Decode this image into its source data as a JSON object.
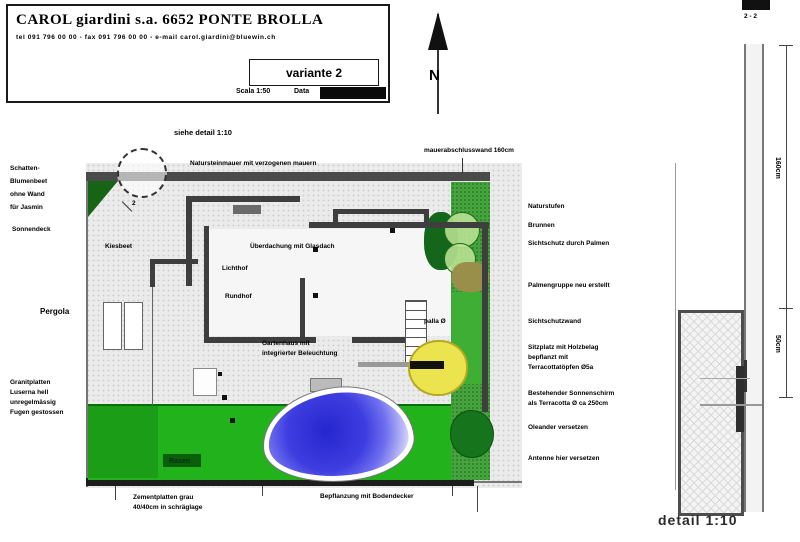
{
  "title_block": {
    "company": "CAROL giardini s.a. 6652 PONTE BROLLA",
    "contact": "tel 091 796 00 00 - fax 091 796 00 00 - e-mail carol.giardini@bluewin.ch",
    "variant": "variante 2",
    "scale_label": "Scala 1:50",
    "date_label": "Data"
  },
  "north_letter": "N",
  "plan_labels": {
    "see_detail": "siehe detail 1:10",
    "top_wall": "Natursteinmauer mit verzogenen mauern",
    "wall_end": "mauerabschlusswand 160cm",
    "kiesbeet": "Kiesbeet",
    "glass_roof": "Überdachung mit Glasdach",
    "lichthof": "Lichthof",
    "rundhof": "Rundhof",
    "gartenhaus_line1": "Gartenhaus mit",
    "gartenhaus_line2": "integrierter Beleuchtung",
    "palla": "palla Ø",
    "rasen": "Rasen",
    "section_marker": "2"
  },
  "left_labels": {
    "block1": [
      "Schatten-",
      "Blumenbeet",
      "ohne Wand",
      "für Jasmin"
    ],
    "sonnendeck": "Sonnendeck",
    "pergola": "Pergola",
    "block2": [
      "Granitplatten",
      "Luserna hell",
      "unregelmässig",
      "Fugen gestossen"
    ]
  },
  "bottom_labels": {
    "zement_line1": "Zementplatten grau",
    "zement_line2": "40/40cm in schräglage",
    "bepflanzung": "Bepflanzung mit Bodendecker"
  },
  "right_labels": [
    "Naturstufen",
    "Brunnen",
    "Sichtschutz durch Palmen",
    "Palmengruppe neu erstellt",
    "Sichtschutzwand",
    "Sitzplatz mit Holzbelag",
    "bepflanzt mit",
    "Terracottatöpfen Ø5a",
    "Bestehender Sonnenschirm",
    "als Terracotta Ø ca 250cm",
    "Oleander versetzen",
    "Antenne hier versetzen"
  ],
  "detail_view": {
    "section_mark": "2 - 2",
    "dim_upper": "160cm",
    "dim_lower": "50cm",
    "caption": "detail 1:10"
  },
  "colors": {
    "lawn_green": "#22b31c",
    "dark_green": "#176417",
    "strip_green": "#46a33e",
    "pool_blue": "#3a3ae0",
    "tree_yellow": "#ece44e",
    "wall_gray": "#3e3e3e"
  }
}
